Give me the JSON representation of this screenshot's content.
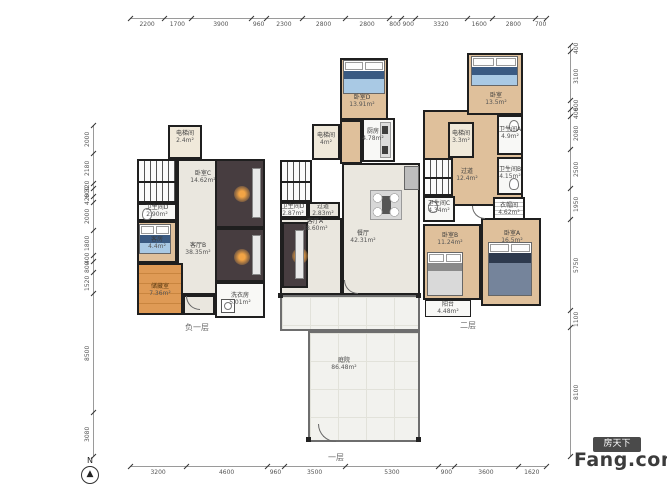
{
  "dimensions": {
    "top": [
      2200,
      1700,
      3900,
      960,
      2300,
      2800,
      2800,
      800,
      900,
      3320,
      1600,
      2800,
      700
    ],
    "bottom": [
      3200,
      4600,
      960,
      3500,
      5300,
      900,
      3600,
      1620
    ],
    "left": [
      2000,
      2180,
      320,
      600,
      420,
      2000,
      1800,
      400,
      800,
      1520,
      8500,
      3080
    ],
    "right": [
      400,
      3100,
      600,
      400,
      2080,
      2500,
      1950,
      5750,
      1100,
      8100
    ]
  },
  "floors": [
    {
      "label": "负一层",
      "rooms": [
        {
          "name": "电梯间",
          "area": "2.4m²"
        },
        {
          "name": "卫生间D",
          "area": "2.90m²"
        },
        {
          "name": "客房",
          "area": "4.4m²"
        },
        {
          "name": "卧室C",
          "area": "14.62m²"
        },
        {
          "name": "客厅B",
          "area": "38.35m²"
        },
        {
          "name": "储藏室",
          "area": "7.36m²"
        },
        {
          "name": "洗衣房",
          "area": "5.01m²"
        }
      ]
    },
    {
      "label": "一层",
      "rooms": [
        {
          "name": "卧室D",
          "area": "13.91m²"
        },
        {
          "name": "电梯间",
          "area": "4m²"
        },
        {
          "name": "厨房",
          "area": "4.78m²"
        },
        {
          "name": "卫生间D",
          "area": "2.87m²"
        },
        {
          "name": "过道",
          "area": "2.83m²"
        },
        {
          "name": "客厅A",
          "area": "18.60m²"
        },
        {
          "name": "餐厅",
          "area": "42.31m²"
        },
        {
          "name": "庭院",
          "area": "86.48m²"
        }
      ]
    },
    {
      "label": "二层",
      "rooms": [
        {
          "name": "卧室",
          "area": "13.5m²"
        },
        {
          "name": "卫生间A",
          "area": "4.9m²"
        },
        {
          "name": "电梯间",
          "area": "3.3m²"
        },
        {
          "name": "过道",
          "area": "12.4m²"
        },
        {
          "name": "卫生间B",
          "area": "4.15m²"
        },
        {
          "name": "卫生间C",
          "area": "4.34m²"
        },
        {
          "name": "衣帽间",
          "area": "4.62m²"
        },
        {
          "name": "卧室B",
          "area": "11.24m²"
        },
        {
          "name": "卧室A",
          "area": "16.5m²"
        },
        {
          "name": "阳台",
          "area": "4.48m²"
        }
      ]
    }
  ],
  "compass": {
    "label": "N"
  },
  "watermark": {
    "brand_box": "房天下",
    "brand": "Fang.com"
  },
  "colors": {
    "wall": "#1f1f1f",
    "wood_floor": "#dfc09b",
    "media_room": "#473d40",
    "storage": "#df9a55",
    "garden": "#f2f2ee",
    "watermark_box": "#4a4a4a"
  }
}
